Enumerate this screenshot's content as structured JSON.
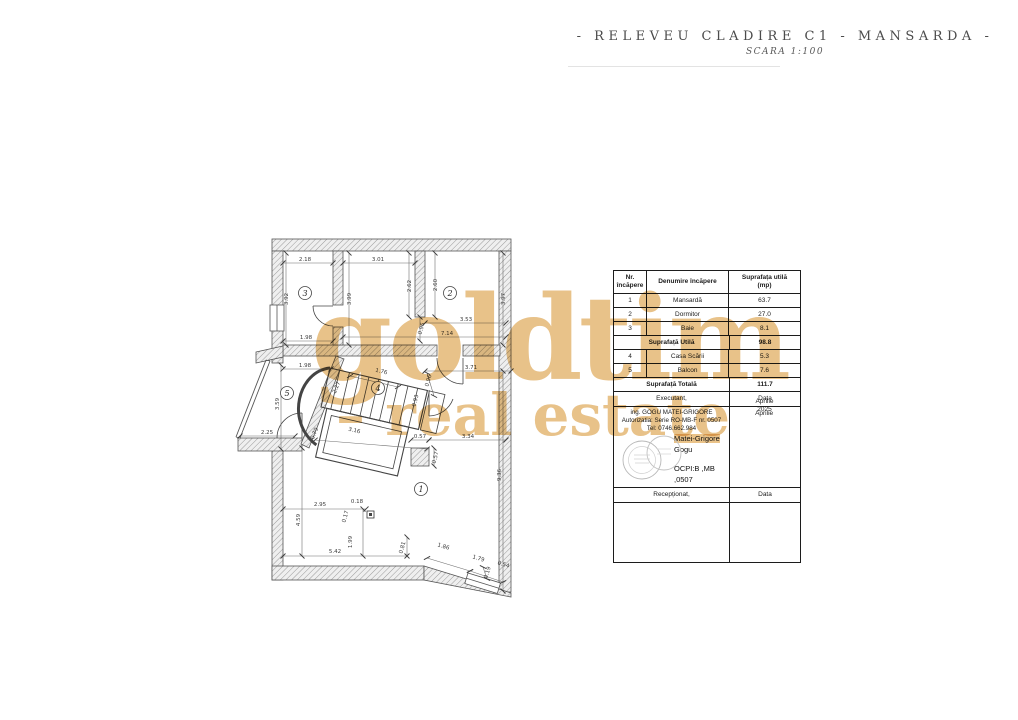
{
  "title": {
    "main": "- RELEVEU CLADIRE C1 - MANSARDA -",
    "scale": "SCARA 1:100"
  },
  "watermark": {
    "line1": "goldtim",
    "line2": "– real estate",
    "color": "#e8c289"
  },
  "table": {
    "col1_header": "Nr.\nîncăpere",
    "col2_header": "Denumire încăpere",
    "col3_header": "Suprafața utilă\n(mp)",
    "rows": [
      {
        "nr": "1",
        "name": "Mansardă",
        "area": "63.7"
      },
      {
        "nr": "2",
        "name": "Dormitor",
        "area": "27.0"
      },
      {
        "nr": "3",
        "name": "Baie",
        "area": "8.1"
      }
    ],
    "subtotal": {
      "label": "Suprafață Utilă",
      "value": "98.8"
    },
    "rows2": [
      {
        "nr": "4",
        "name": "Casa Scării",
        "area": "5.3"
      },
      {
        "nr": "5",
        "name": "Balcon",
        "area": "7.6"
      }
    ],
    "total": {
      "label": "Suprafață Totală",
      "value": "111.7"
    },
    "executant": {
      "label": "Executant,",
      "data_label": "Data",
      "line1": "ing. GOGU MATEI-GRIGORE",
      "line2": "Autorizatia: Serie RO-MB-F nr. 0507",
      "line3": "Tel: 0746.662.984",
      "date1": "Aprilie",
      "date2": "2025",
      "stamp_name1": "Matei-Grigore",
      "stamp_name2": "Gogu",
      "stamp_id1": "OCPI:B ,MB",
      "stamp_id2": ",0507"
    },
    "receptionat": {
      "label": "Recepționat,",
      "data_label": "Data"
    }
  },
  "plan": {
    "rooms": [
      {
        "n": "1",
        "x": 421,
        "y": 489
      },
      {
        "n": "2",
        "x": 450,
        "y": 293
      },
      {
        "n": "3",
        "x": 305,
        "y": 293
      },
      {
        "n": "4",
        "x": 378,
        "y": 388
      },
      {
        "n": "5",
        "x": 287,
        "y": 393
      }
    ],
    "dims": [
      {
        "t": "2.18",
        "x": 305,
        "y": 261
      },
      {
        "t": "3.01",
        "x": 378,
        "y": 261
      },
      {
        "t": "3.92",
        "x": 288,
        "y": 299,
        "r": -90
      },
      {
        "t": "3.99",
        "x": 351,
        "y": 299,
        "r": -90
      },
      {
        "t": "2.62",
        "x": 411,
        "y": 286,
        "r": -90
      },
      {
        "t": "2.60",
        "x": 437,
        "y": 285,
        "r": -90
      },
      {
        "t": "3.97",
        "x": 505,
        "y": 299,
        "r": -90
      },
      {
        "t": "3.53",
        "x": 466,
        "y": 321
      },
      {
        "t": "0.96",
        "x": 423,
        "y": 329,
        "r": -75
      },
      {
        "t": "1.98",
        "x": 306,
        "y": 339
      },
      {
        "t": "7.14",
        "x": 447,
        "y": 335
      },
      {
        "t": "1.98",
        "x": 305,
        "y": 367
      },
      {
        "t": "3.71",
        "x": 471,
        "y": 369
      },
      {
        "t": "1.76",
        "x": 381,
        "y": 373,
        "r": 13
      },
      {
        "t": "0.96",
        "x": 430,
        "y": 381,
        "r": -75
      },
      {
        "t": "2.27",
        "x": 338,
        "y": 388,
        "r": -68
      },
      {
        "t": "0.93",
        "x": 417,
        "y": 401,
        "r": -75
      },
      {
        "t": "3.59",
        "x": 279,
        "y": 404,
        "r": -90
      },
      {
        "t": "2.25",
        "x": 267,
        "y": 434
      },
      {
        "t": "0.79",
        "x": 316,
        "y": 434,
        "r": -68
      },
      {
        "t": "3.16",
        "x": 354,
        "y": 432,
        "r": 13
      },
      {
        "t": "0.57",
        "x": 420,
        "y": 438
      },
      {
        "t": "3.34",
        "x": 468,
        "y": 438
      },
      {
        "t": "0.57",
        "x": 437,
        "y": 458,
        "r": -75
      },
      {
        "t": "9.36",
        "x": 501,
        "y": 475,
        "r": -90
      },
      {
        "t": "4.59",
        "x": 300,
        "y": 520,
        "r": -90
      },
      {
        "t": "2.95",
        "x": 320,
        "y": 506
      },
      {
        "t": "0.18",
        "x": 357,
        "y": 503
      },
      {
        "t": "0.17",
        "x": 347,
        "y": 517,
        "r": -75
      },
      {
        "t": "1.99",
        "x": 352,
        "y": 542,
        "r": -90
      },
      {
        "t": "0.81",
        "x": 404,
        "y": 548,
        "r": -75
      },
      {
        "t": "5.42",
        "x": 335,
        "y": 553
      },
      {
        "t": "1.86",
        "x": 443,
        "y": 548,
        "r": 17
      },
      {
        "t": "1.79",
        "x": 478,
        "y": 560,
        "r": 17
      },
      {
        "t": "0.19",
        "x": 489,
        "y": 573,
        "r": -73
      },
      {
        "t": "0.54",
        "x": 503,
        "y": 566,
        "r": 17
      }
    ]
  }
}
